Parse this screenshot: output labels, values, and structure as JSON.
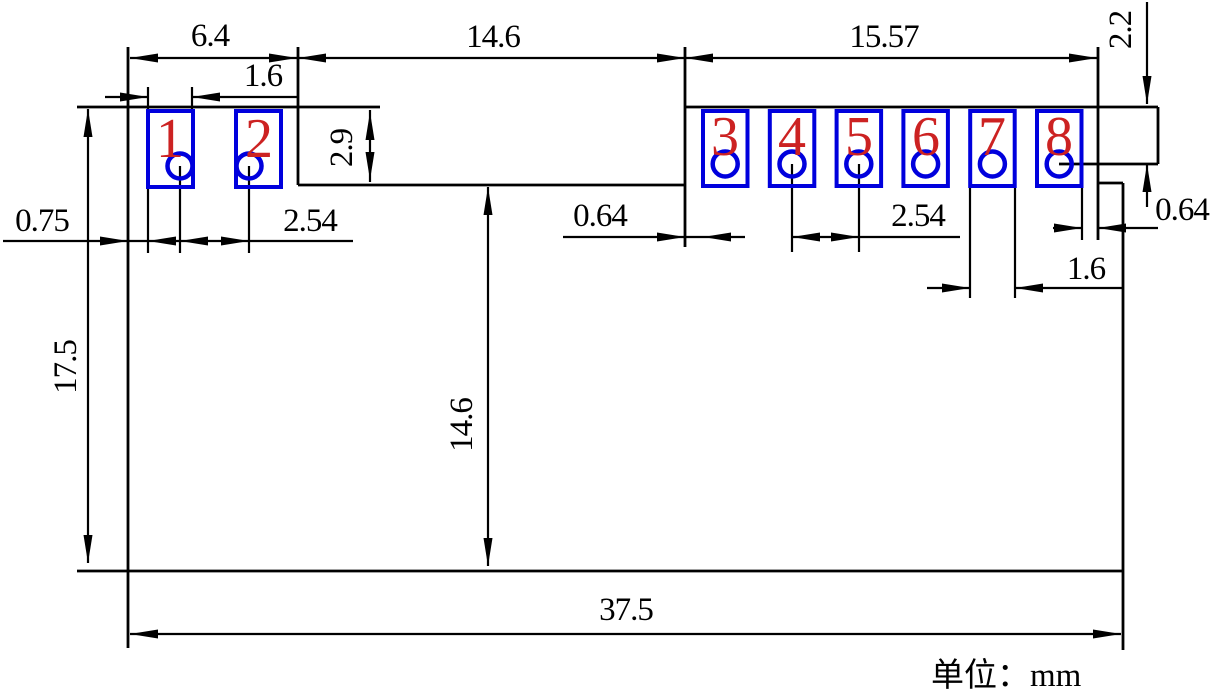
{
  "drawing": {
    "title_note": "单位：mm",
    "colors": {
      "pad_outline": "#0000dd",
      "pin_number": "#cc2222",
      "line": "#000000"
    },
    "pads": [
      {
        "number": "1"
      },
      {
        "number": "2"
      },
      {
        "number": "3"
      },
      {
        "number": "4"
      },
      {
        "number": "5"
      },
      {
        "number": "6"
      },
      {
        "number": "7"
      },
      {
        "number": "8"
      }
    ],
    "dimensions": {
      "left_section_width": "6.4",
      "pad1_width": "1.6",
      "notch_width": "14.6",
      "right_section_width": "15.57",
      "top_edge_to_pin_line": "2.2",
      "left_edge_to_pad1": "0.75",
      "pad1_pad2_pitch": "2.54",
      "edge_to_pad3": "0.64",
      "pad4_pad5_pitch": "2.54",
      "pad_height": "2.9",
      "body_height": "17.5",
      "notch_depth": "14.6",
      "pad7_width": "1.6",
      "pad8_to_edge": "0.64",
      "total_width": "37.5"
    }
  }
}
